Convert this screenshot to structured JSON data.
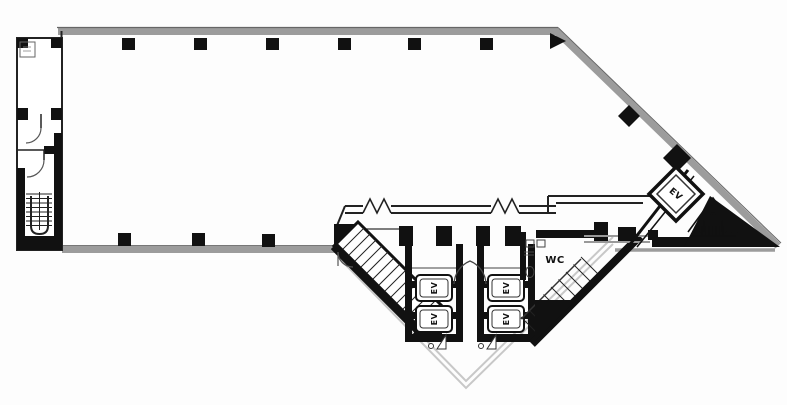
{
  "plan": {
    "core": {
      "elevator_bank_left": {
        "cars": [
          {
            "label": "EV"
          },
          {
            "label": "EV"
          }
        ]
      },
      "elevator_bank_right": {
        "cars": [
          {
            "label": "EV"
          },
          {
            "label": "EV"
          }
        ]
      },
      "toilet": {
        "label": "WC"
      }
    },
    "corner_core": {
      "elevator": {
        "label": "EV"
      }
    },
    "colors": {
      "outer_wall": "#9c9c9c",
      "core_wall": "#151515",
      "canopy_line": "#c8c8c8"
    },
    "icons": {
      "stairs": "stair-stripes",
      "escalator": "nested-chevrons",
      "door": "quarter-arc-swing",
      "column": "filled-square"
    }
  }
}
